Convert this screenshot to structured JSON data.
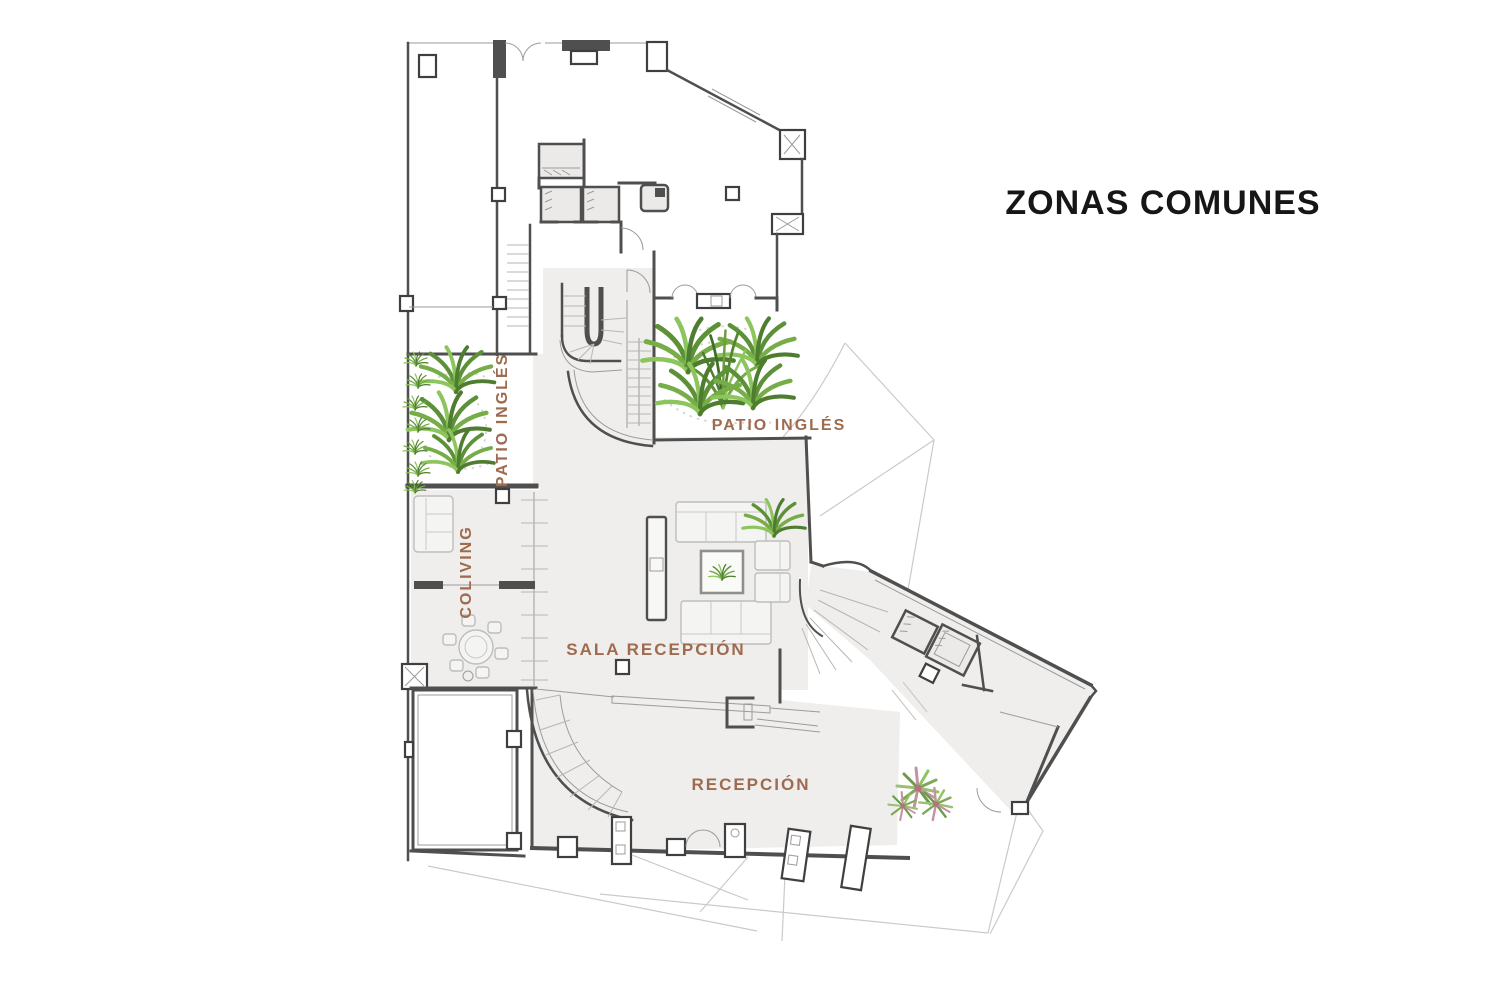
{
  "title": "ZONAS COMUNES",
  "labels": {
    "patio_left": "PATIO INGLÉS",
    "patio_top": "PATIO INGLÉS",
    "coliving": "COLIVING",
    "sala_recepcion": "SALA RECEPCIÓN",
    "recepcion": "RECEPCIÓN"
  },
  "colors": {
    "title_text": "#161616",
    "label_text": "#9e6b4f",
    "wall": "#4f4f4f",
    "floor_fill": "#efeeec",
    "site_line": "#cbcac8",
    "plant_green": "#6ba33f",
    "plant_green_dark": "#4e7d30",
    "plant_green_light": "#8cc55c",
    "shrub_pink": "#c394a0"
  }
}
